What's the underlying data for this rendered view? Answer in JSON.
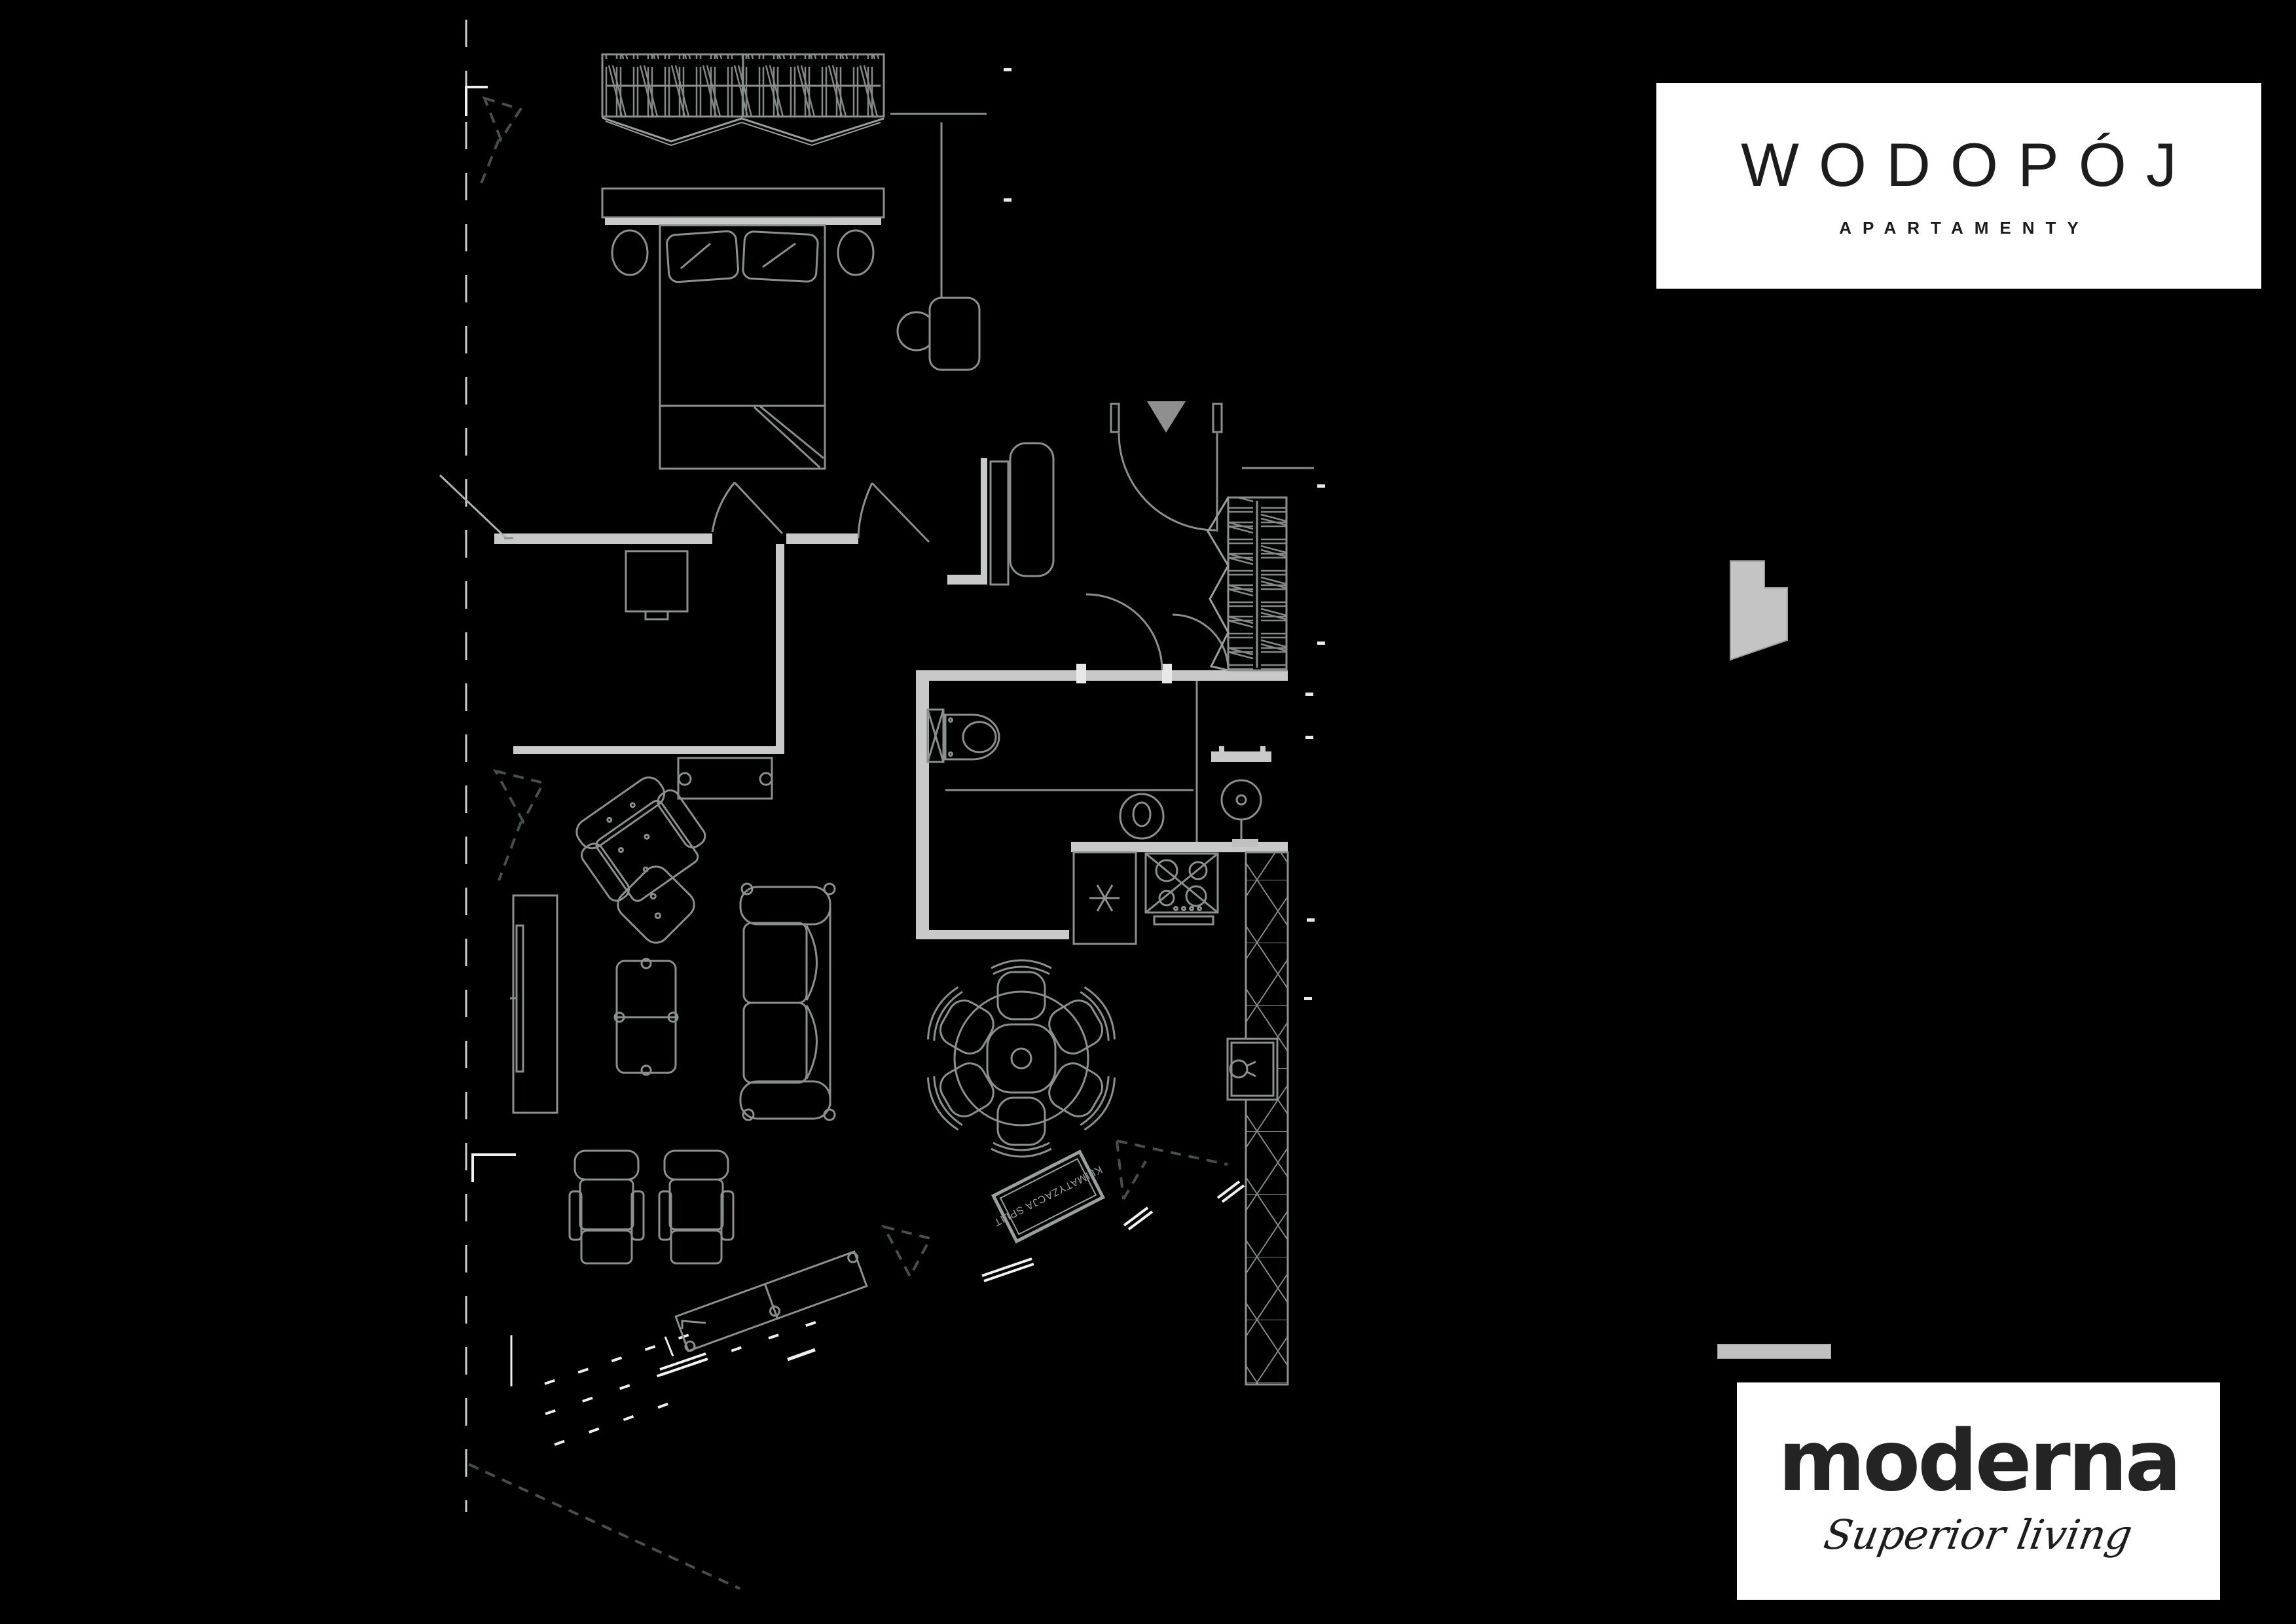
{
  "brand_top": {
    "name": "WODOPÓJ",
    "subtitle": "APARTAMENTY"
  },
  "brand_bottom": {
    "name": "moderna",
    "subtitle": "Superior living"
  },
  "floor_plan": {
    "ac_label": "KLIMATYZACJA SPLIT",
    "icon_names": [
      "entrance-door-icon",
      "bed-icon",
      "wardrobe-icon",
      "closet-icon",
      "toilet-icon",
      "washbasin-icon",
      "fridge-snowflake-icon",
      "hob-icon",
      "kitchen-sink-icon",
      "dining-table-icon",
      "sofa-icon",
      "armchair-icon",
      "lounge-chairs-icon",
      "tv-console-icon",
      "coffee-table-icon",
      "building-silhouette-icon"
    ]
  },
  "colors": {
    "background": "#000000",
    "wall_fill": "#c9c9c9",
    "furniture_line": "#8b908f",
    "dashed_boundary": "#45504c",
    "white_line": "#f0f0f0",
    "logo_box": "#ffffff",
    "logo_text": "#1c1c1c",
    "divider_bar": "#c0c0c0",
    "silhouette_fill": "#c4c4c4"
  }
}
